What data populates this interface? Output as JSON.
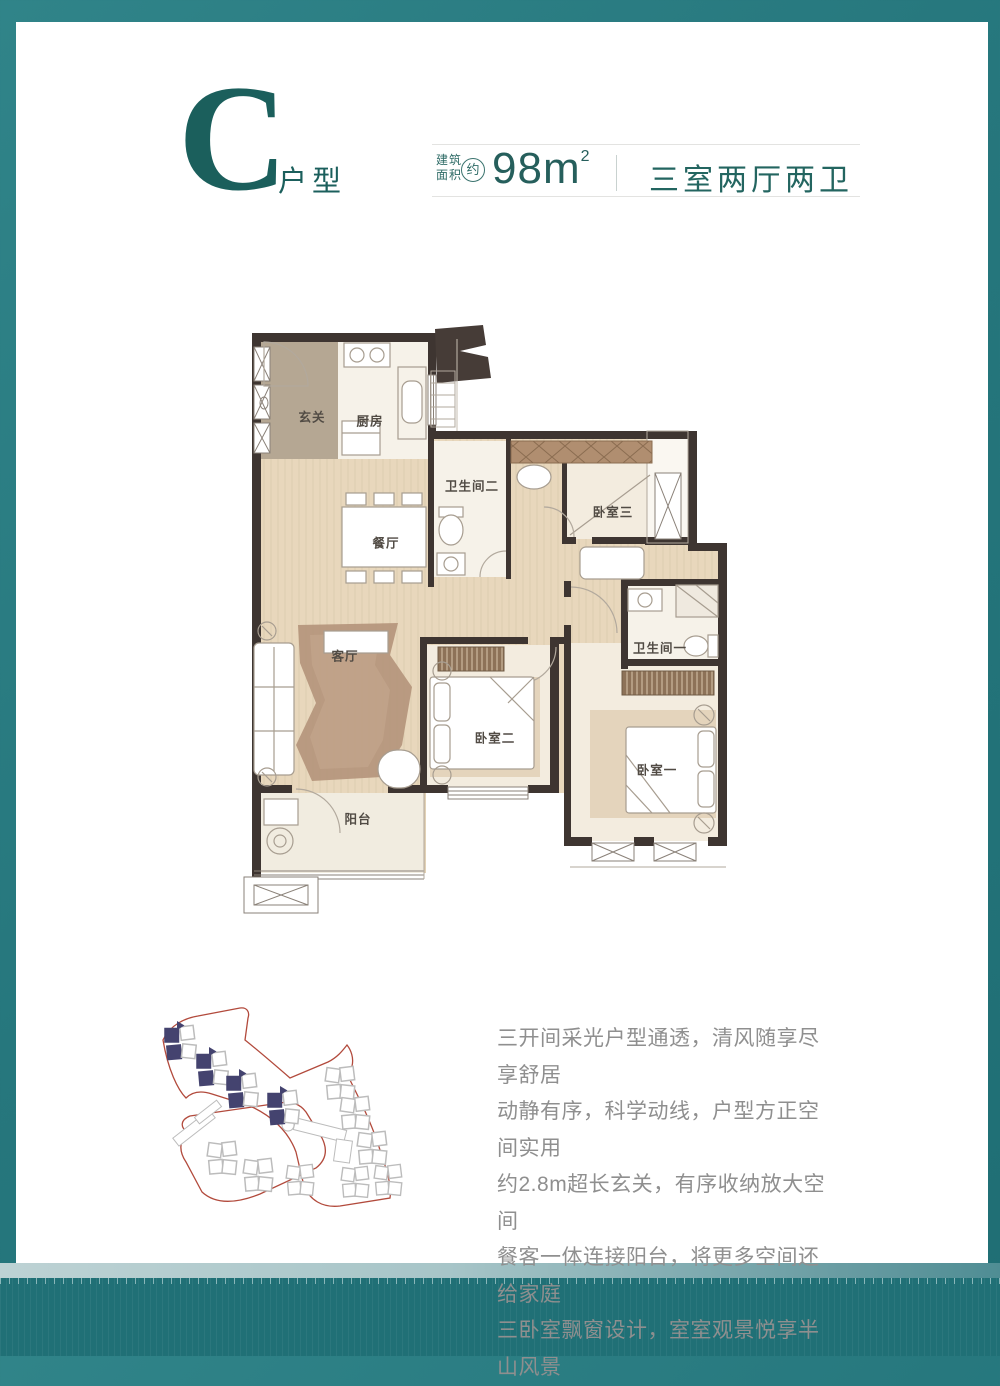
{
  "header": {
    "unit_letter": "C",
    "unit_type_label": "户型",
    "area_label_line1": "建筑",
    "area_label_line2": "面积",
    "area_approx_mark": "约",
    "area_value": "98m",
    "area_exponent": "2",
    "layout_spec": "三室两厅两卫"
  },
  "floor_plan": {
    "rooms": [
      {
        "id": "entry",
        "label": "玄关"
      },
      {
        "id": "kitchen",
        "label": "厨房"
      },
      {
        "id": "dining",
        "label": "餐厅"
      },
      {
        "id": "bath2",
        "label": "卫生间二"
      },
      {
        "id": "bedroom3",
        "label": "卧室三"
      },
      {
        "id": "bath1",
        "label": "卫生间一"
      },
      {
        "id": "living",
        "label": "客厅"
      },
      {
        "id": "bedroom2",
        "label": "卧室二"
      },
      {
        "id": "bedroom1",
        "label": "卧室一"
      },
      {
        "id": "balcony",
        "label": "阳台"
      }
    ]
  },
  "description": {
    "lines": [
      "三开间采光户型通透，清风随享尽享舒居",
      "动静有序，科学动线，户型方正空间实用",
      "约2.8m超长玄关，有序收纳放大空间",
      "餐客一体连接阳台，将更多空间还给家庭",
      "三卧室飘窗设计，室室观景悦享半山风景"
    ]
  },
  "colors": {
    "frame_teal": "#26777d",
    "frame_teal_dark": "#207076",
    "band_light": "#a7c5c8",
    "title_teal": "#1b5f5c",
    "spec_teal": "#236560",
    "description_gray": "#8f8f8f",
    "wall_dark": "#3e3531",
    "floor_beige": "#e8d7bc",
    "entry_floor_tan": "#b5a793",
    "room_cream": "#f3ecdf",
    "rug_brown": "#b4937a",
    "wardrobe_brown": "#b08e70",
    "site_outline_red": "#b24a3c",
    "site_highlight_navy": "#44436f"
  }
}
